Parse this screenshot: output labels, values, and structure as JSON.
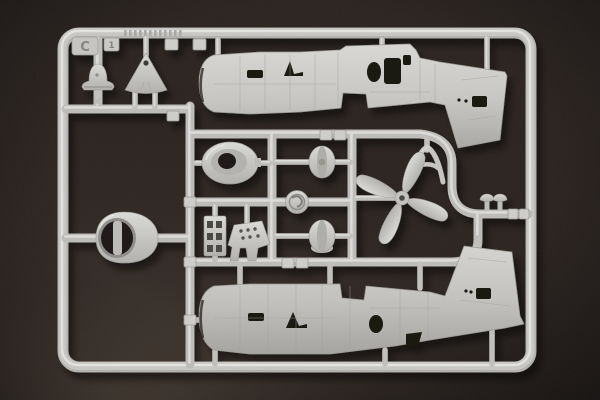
{
  "scene": {
    "subject": "Photograph of a light-gray injection-molded plastic model kit sprue (parts runner) of an aircraft kit on a dark brown background",
    "background_color": "#2a2320",
    "plastic_color": "#c9c8c5",
    "shadow_color": "#000000"
  },
  "sprue": {
    "letter": "C",
    "tag_number": "1",
    "parts": [
      "fuselage-half-upper",
      "fuselage-half-lower",
      "propeller-four-blade",
      "engine-cowling",
      "cowl-ring",
      "main-wheel-upper",
      "main-wheel-lower",
      "hub-cap-medallion",
      "radiator-ladder",
      "instrument-panel",
      "nose-dome",
      "fin-tip-triangle",
      "wishbone-strut",
      "mushroom-pin-left",
      "mushroom-pin-right"
    ]
  }
}
